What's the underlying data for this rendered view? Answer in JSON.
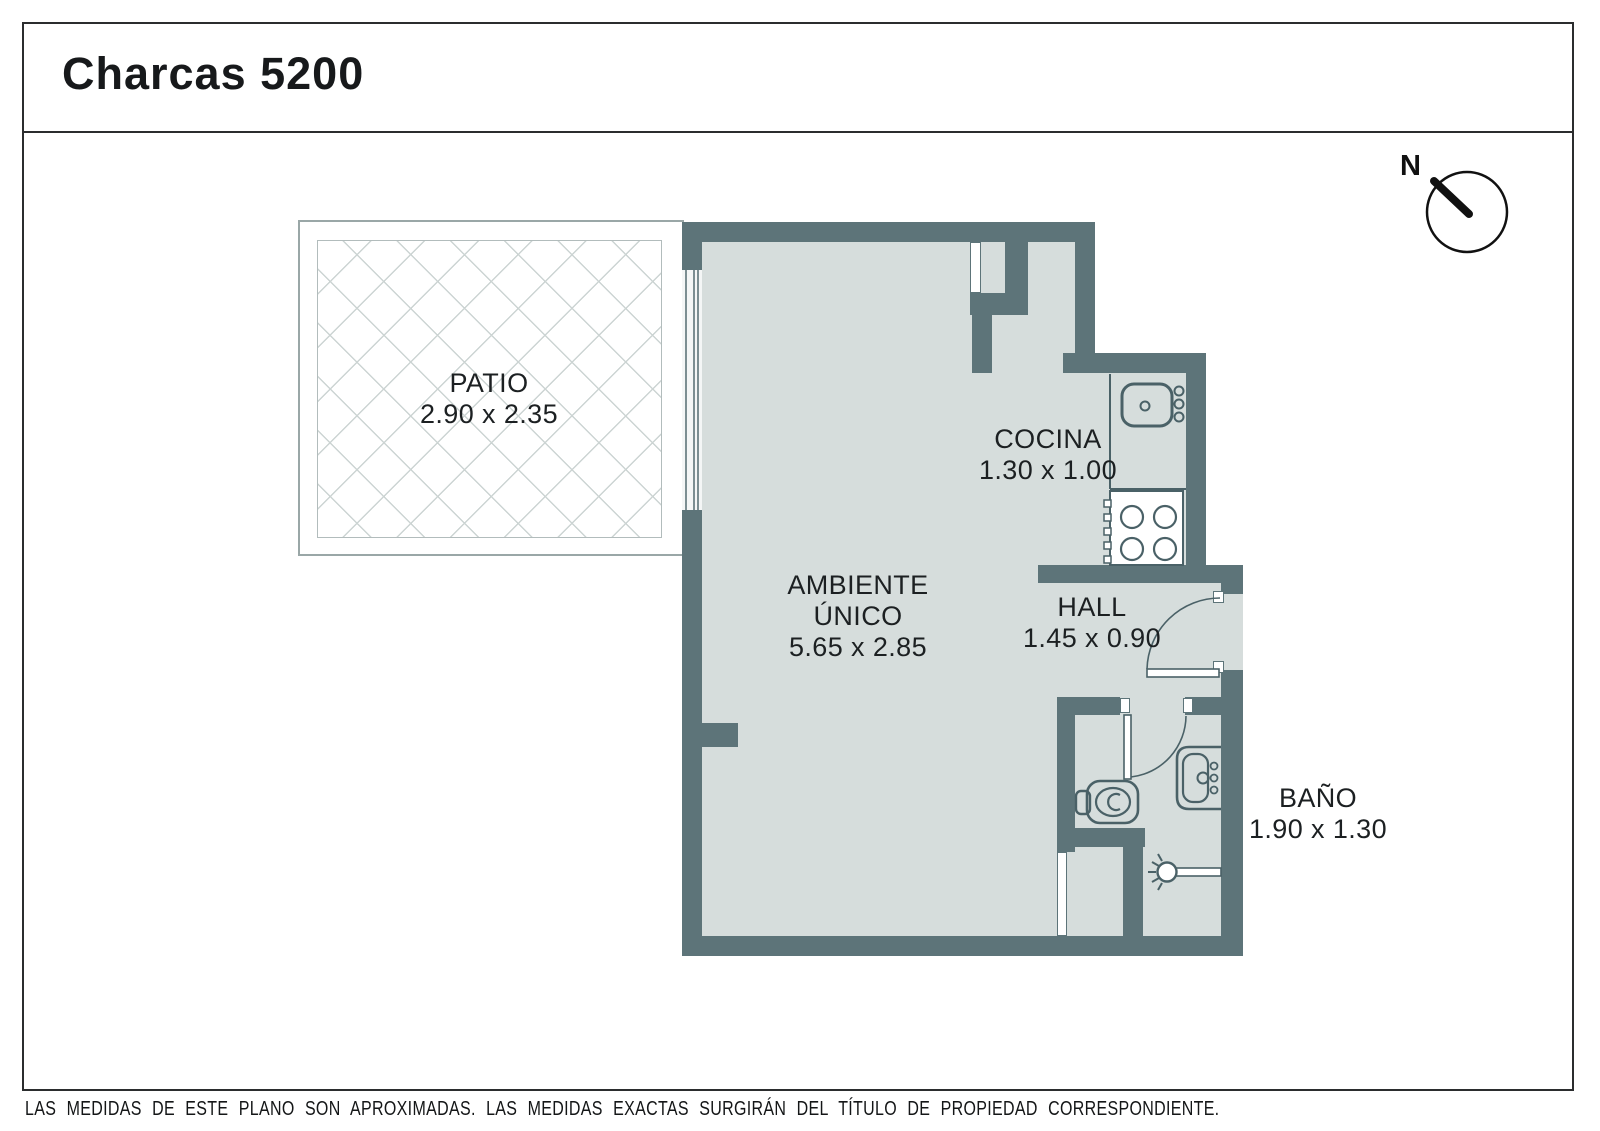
{
  "header": {
    "title": "Charcas 5200"
  },
  "compass": {
    "north_label": "N"
  },
  "rooms": {
    "patio": {
      "name": "PATIO",
      "dims": "2.90 x 2.35"
    },
    "ambiente": {
      "name_line1": "AMBIENTE",
      "name_line2": "ÚNICO",
      "dims": "5.65 x 2.85"
    },
    "cocina": {
      "name": "COCINA",
      "dims": "1.30 x 1.00"
    },
    "hall": {
      "name": "HALL",
      "dims": "1.45 x 0.90"
    },
    "bano": {
      "name": "BAÑO",
      "dims": "1.90 x 1.30"
    }
  },
  "fixtures": [
    "window",
    "entry-door",
    "bathroom-door",
    "kitchen-sink",
    "stove",
    "toilet",
    "bathroom-sink",
    "shower",
    "compass"
  ],
  "footer": {
    "disclaimer": "LAS MEDIDAS DE ESTE PLANO SON APROXIMADAS. LAS MEDIDAS EXACTAS SURGIRÁN DEL TÍTULO DE PROPIEDAD CORRESPONDIENTE.",
    "credit": "CONFECCIONADO POR ESTUDIO NARTEX"
  },
  "colors": {
    "wall": "#5d7479",
    "floor": "#d6dddc",
    "fixture_outline": "#4a6167",
    "hatch_line": "#ccd4d3",
    "patio_border": "#9aa7a7",
    "text": "#1c2022"
  }
}
